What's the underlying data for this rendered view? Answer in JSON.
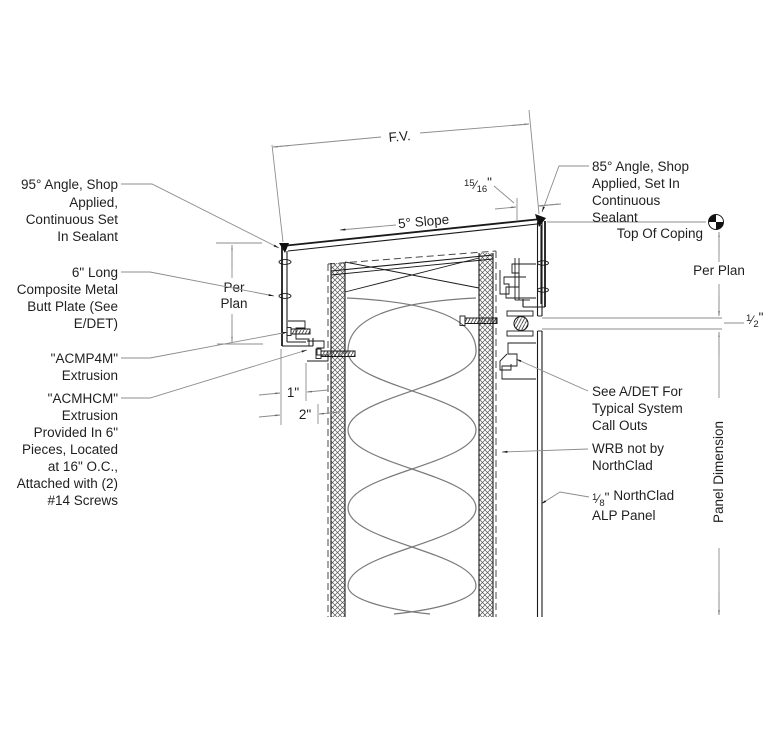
{
  "labels": {
    "angle95": {
      "lines": [
        "95° Angle, Shop",
        "Applied,",
        "Continuous Set",
        "In Sealant"
      ]
    },
    "buttPlate": {
      "lines": [
        "6\" Long",
        "Composite Metal",
        "Butt Plate (See",
        "E/DET)"
      ]
    },
    "acmp4m": {
      "lines": [
        "\"ACMP4M\"",
        "Extrusion"
      ]
    },
    "acmhcm": {
      "lines": [
        "\"ACMHCM\"",
        "Extrusion",
        "Provided In 6\"",
        "Pieces, Located",
        "at 16\" O.C.,",
        "Attached with (2)",
        "#14 Screws"
      ]
    },
    "angle85": {
      "lines": [
        "85° Angle, Shop",
        "Applied,  Set In",
        "Continuous",
        "Sealant"
      ]
    },
    "seeADet": {
      "lines": [
        "See A/DET For",
        "Typical System",
        "Call Outs"
      ]
    },
    "wrb": {
      "lines": [
        "WRB not by",
        "NorthClad"
      ]
    },
    "alpPanel": {
      "prefix": {
        "num": "1",
        "den": "8",
        "unit": "\""
      },
      "line1": "NorthClad",
      "line2": "ALP Panel"
    }
  },
  "dimensions": {
    "fv": "F.V.",
    "slope": "5° Slope",
    "sixteenths": {
      "num": "15",
      "den": "16",
      "unit": "\""
    },
    "half": {
      "num": "1",
      "den": "2",
      "unit": "\""
    },
    "perPlanLeft": {
      "line1": "Per",
      "line2": "Plan"
    },
    "perPlanRight": "Per Plan",
    "topOfCoping": "Top Of Coping",
    "panelDimension": "Panel Dimension",
    "oneInch": "1\"",
    "twoInch": "2\"",
    "fracSlash": "⁄"
  },
  "colors": {
    "line": "#1a1a1a",
    "dim": "#8c8c8c",
    "text": "#1f1f1f",
    "background": "#ffffff"
  }
}
